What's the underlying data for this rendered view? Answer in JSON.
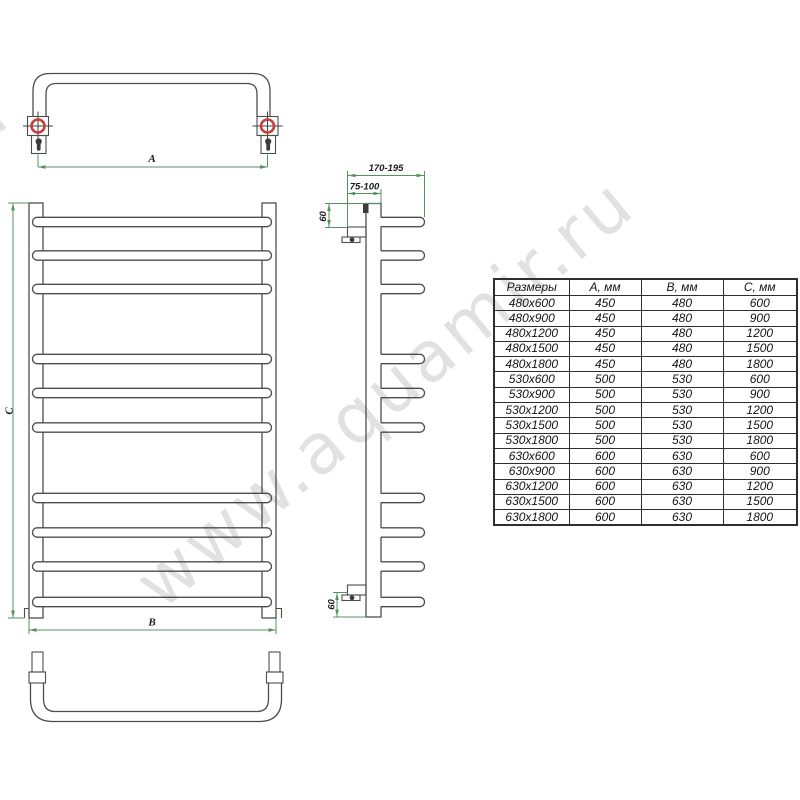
{
  "watermark": {
    "text": "www.aquamir.ru"
  },
  "drawing": {
    "dim_a_label": "А",
    "dim_b_label": "В",
    "dim_c_label": "С",
    "depth_range_label": "170-195",
    "standoff_range_label": "75-100",
    "top_offset_label": "60",
    "bottom_offset_label": "60"
  },
  "table": {
    "headers": [
      "Размеры",
      "А, мм",
      "В, мм",
      "С, мм"
    ],
    "rows": [
      [
        "480х600",
        "450",
        "480",
        "600"
      ],
      [
        "480х900",
        "450",
        "480",
        "900"
      ],
      [
        "480х1200",
        "450",
        "480",
        "1200"
      ],
      [
        "480х1500",
        "450",
        "480",
        "1500"
      ],
      [
        "480х1800",
        "450",
        "480",
        "1800"
      ],
      [
        "530х600",
        "500",
        "530",
        "600"
      ],
      [
        "530х900",
        "500",
        "530",
        "900"
      ],
      [
        "530х1200",
        "500",
        "530",
        "1200"
      ],
      [
        "530х1500",
        "500",
        "530",
        "1500"
      ],
      [
        "530х1800",
        "500",
        "530",
        "1800"
      ],
      [
        "630х600",
        "600",
        "630",
        "600"
      ],
      [
        "630х900",
        "600",
        "630",
        "900"
      ],
      [
        "630х1200",
        "600",
        "630",
        "1200"
      ],
      [
        "630х1500",
        "600",
        "630",
        "1500"
      ],
      [
        "630х1800",
        "600",
        "630",
        "1800"
      ]
    ]
  },
  "colors": {
    "line": "#4d4d4d",
    "dimension_green": "#55935e",
    "mount_red": "#c4403c",
    "table_border": "#2e2e2e",
    "watermark_gray": "#d9d9d9"
  }
}
